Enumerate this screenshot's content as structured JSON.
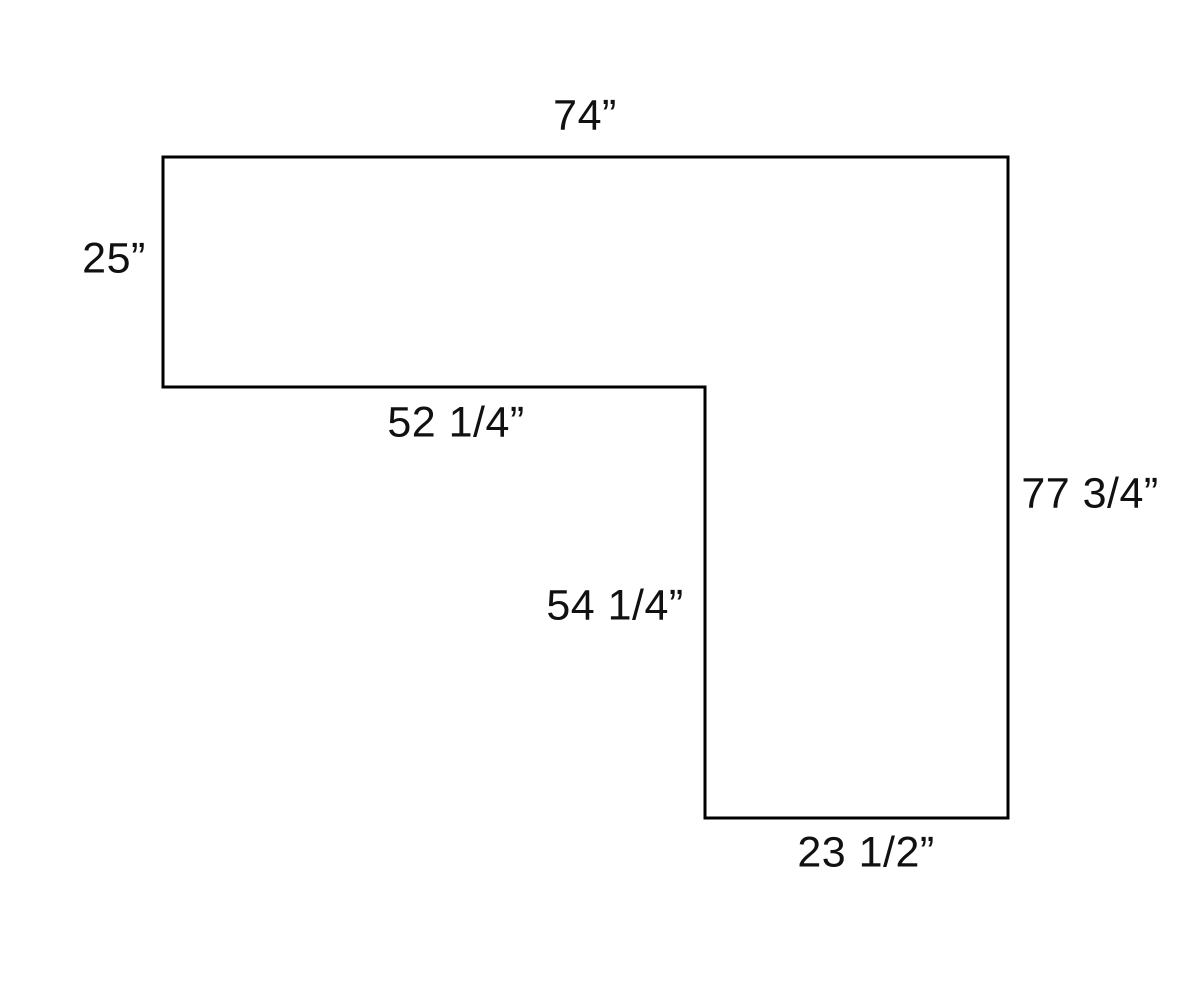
{
  "diagram": {
    "line_color": "#000000",
    "background_color": "#ffffff",
    "labels": {
      "top": "74”",
      "left": "25”",
      "inner_horizontal": "52 1/4”",
      "inner_vertical": "54 1/4”",
      "right": "77 3/4”",
      "bottom": "23 1/2”"
    }
  }
}
